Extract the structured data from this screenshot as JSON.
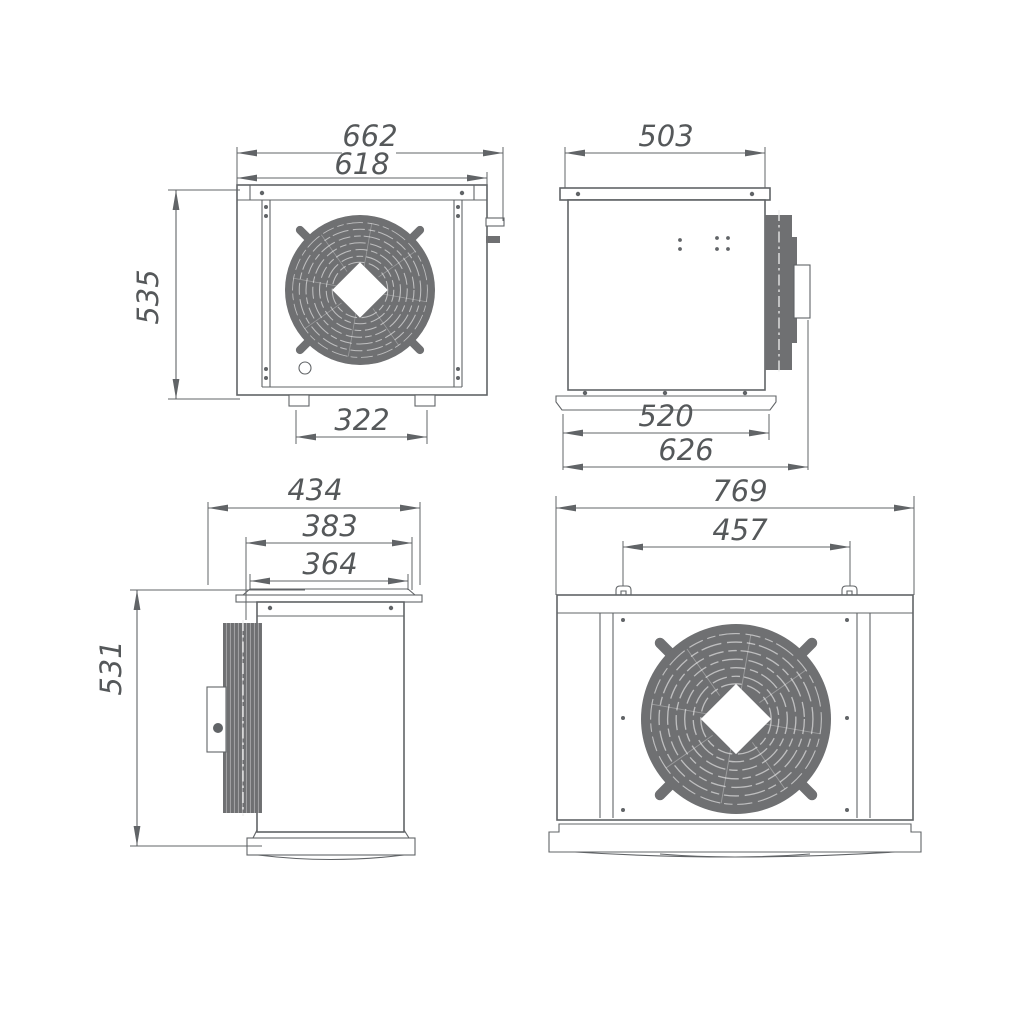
{
  "views": {
    "front": {
      "dims": {
        "overall_width": "662",
        "case_width": "618",
        "height": "535",
        "feet_span": "322"
      }
    },
    "side_right": {
      "dims": {
        "top_width": "503",
        "base_width": "520",
        "overall_depth": "626"
      }
    },
    "side_left": {
      "dims": {
        "overall_depth": "434",
        "case_depth": "383",
        "flange_width": "364",
        "height": "531"
      }
    },
    "back": {
      "dims": {
        "overall_width": "769",
        "bracket_span": "457"
      }
    }
  },
  "colors": {
    "line": "#616467",
    "fill_gray": "#6f7072",
    "dim_text": "#55585a",
    "background": "#ffffff"
  }
}
